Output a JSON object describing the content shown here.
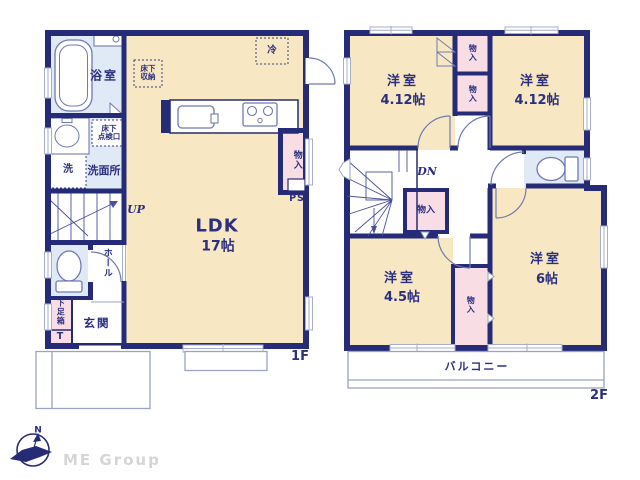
{
  "floor1": {
    "floor_label": "1F",
    "bath": "浴室",
    "underfloor_storage": [
      "床下",
      "収納"
    ],
    "fridge": "冷",
    "inspection": [
      "床下",
      "点検口"
    ],
    "laundry": "洗",
    "washroom": "洗面所",
    "stairs_up": "UP",
    "hall": "ホール",
    "shoe_cabinet": "下足箱",
    "shoe_cabinet_t": "T",
    "entrance": "玄関",
    "ldk_name": "LDK",
    "ldk_size": "17帖",
    "closet": "物入",
    "pipe_space": "PS"
  },
  "floor2": {
    "floor_label": "2F",
    "room_nw_name": "洋室",
    "room_nw_size": "4.12帖",
    "room_ne_name": "洋室",
    "room_ne_size": "4.12帖",
    "closet_a": "物入",
    "closet_b": "物入",
    "closet_mid": "物入",
    "closet_s": "物入",
    "stairs_down": "DN",
    "room_sw_name": "洋室",
    "room_sw_size": "4.5帖",
    "room_se_name": "洋室",
    "room_se_size": "6帖",
    "balcony": "バルコニー"
  },
  "compass": {
    "north": "N"
  },
  "branding": {
    "company": "ME Group"
  },
  "colors": {
    "wall": "#262b77",
    "room": "#f7e8c3",
    "wet_area": "#dfeaf6",
    "closet": "#f9dde4",
    "outline_gray": "#9aa3c0",
    "brand_text": "#d5d5d7"
  }
}
